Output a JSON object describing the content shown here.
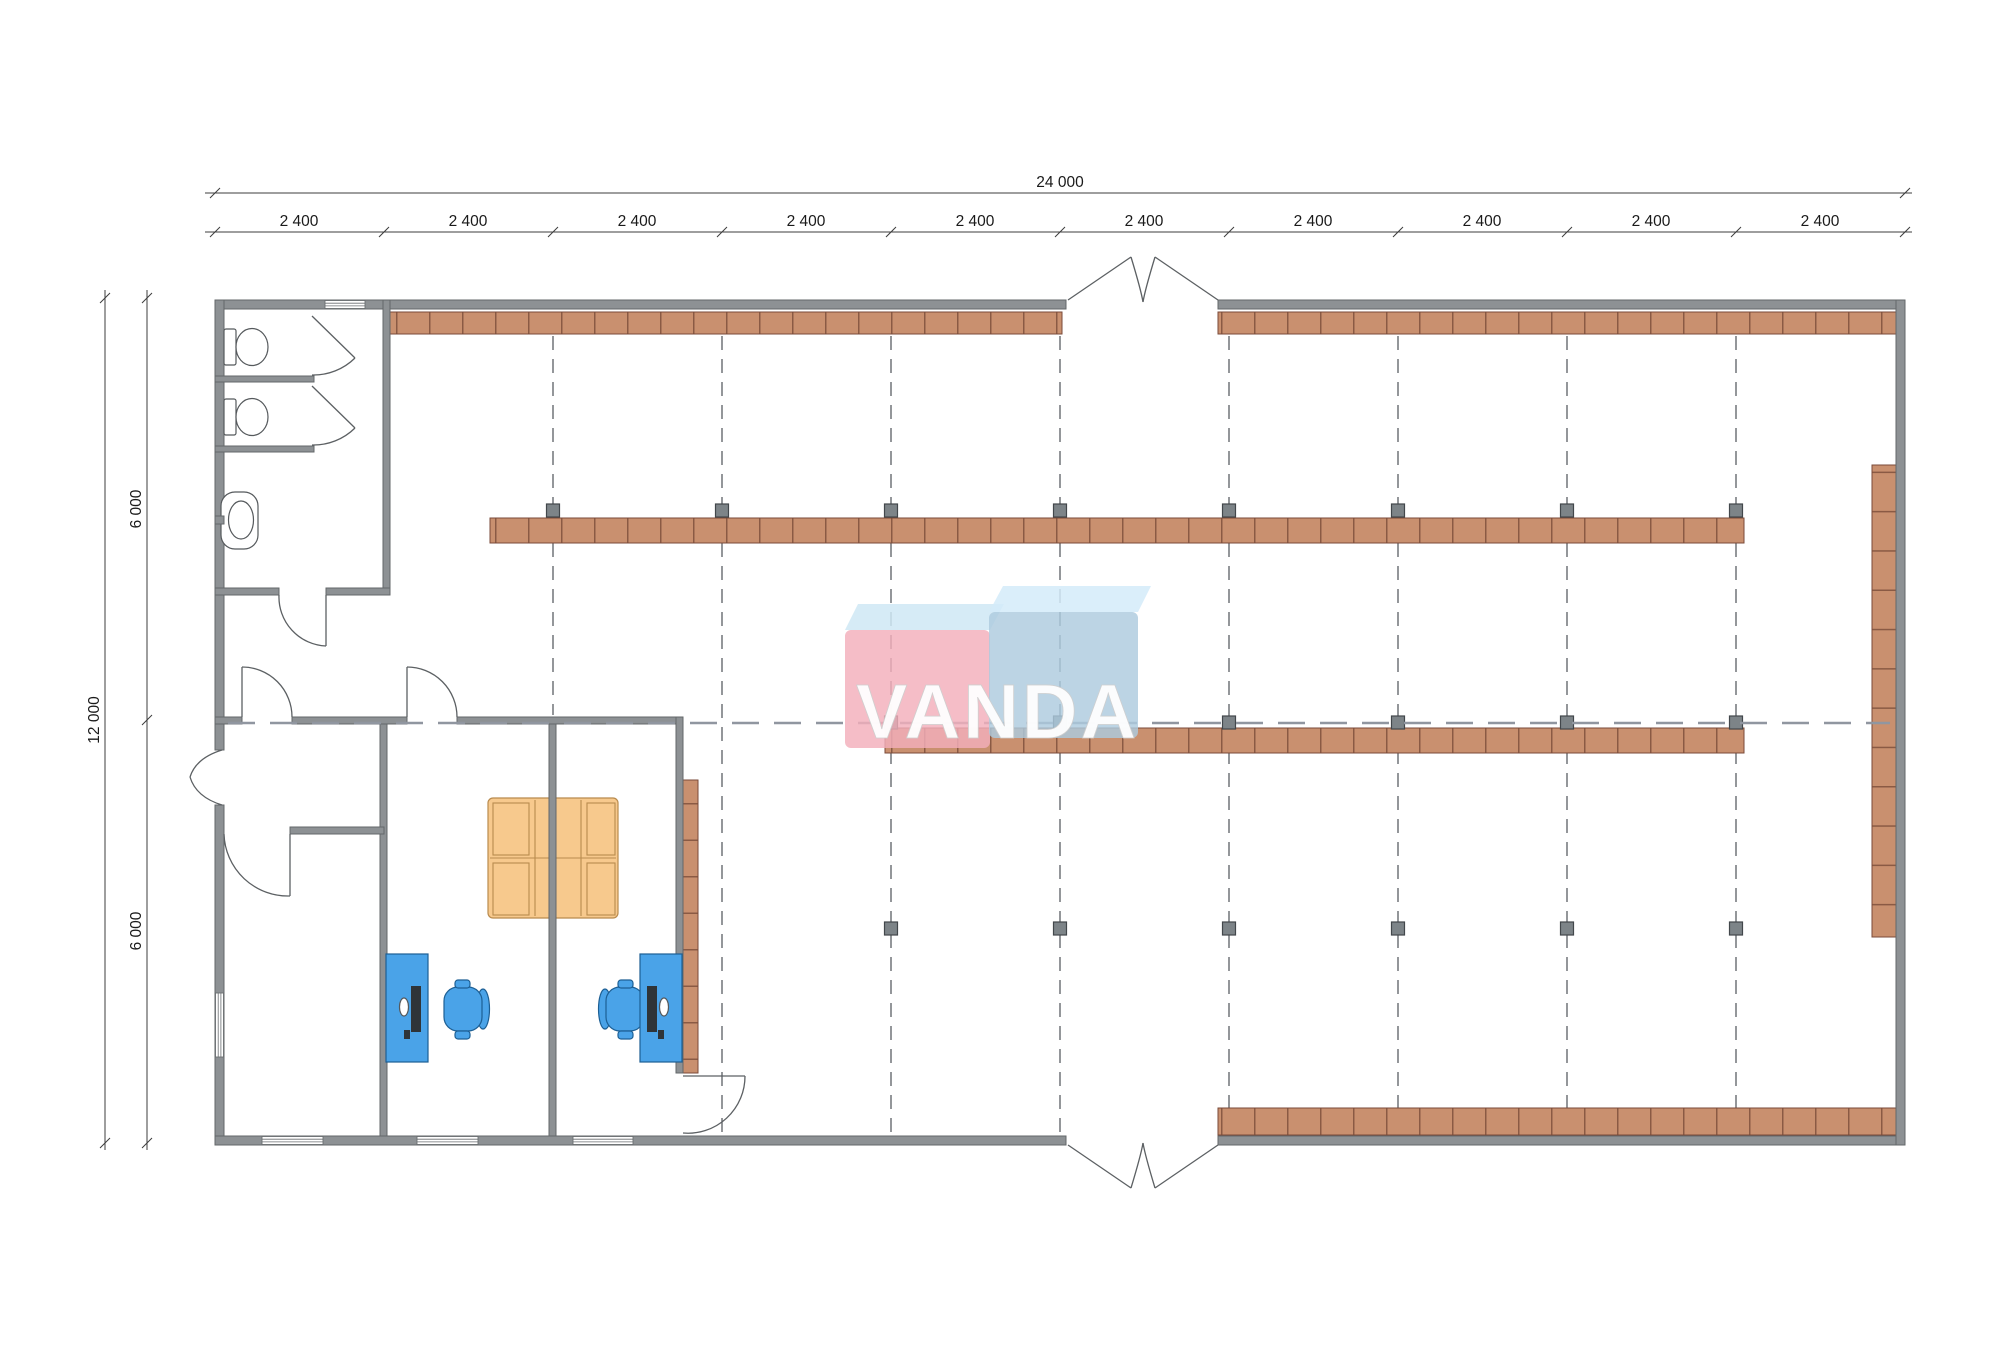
{
  "watermark": {
    "text": "VANDA",
    "pink": "#f3aebb",
    "blue": "#adcade"
  },
  "dimensions": {
    "top_total": "24 000",
    "top_segments": [
      "2 400",
      "2 400",
      "2 400",
      "2 400",
      "2 400",
      "2 400",
      "2 400",
      "2 400",
      "2 400",
      "2 400"
    ],
    "left_total": "12 000",
    "left_segments": [
      "6 000",
      "6 000"
    ]
  },
  "colors": {
    "shelf": "#c9906f",
    "shelf_border": "#7a4a38",
    "wall": "#8d9194",
    "column": "#7d8488",
    "grid_line": "#5a5f63",
    "desk": "#4aa3e8",
    "chair": "#4aa3e8",
    "sofa": "#f7c98d",
    "dimension_text": "#1a1a1a"
  }
}
